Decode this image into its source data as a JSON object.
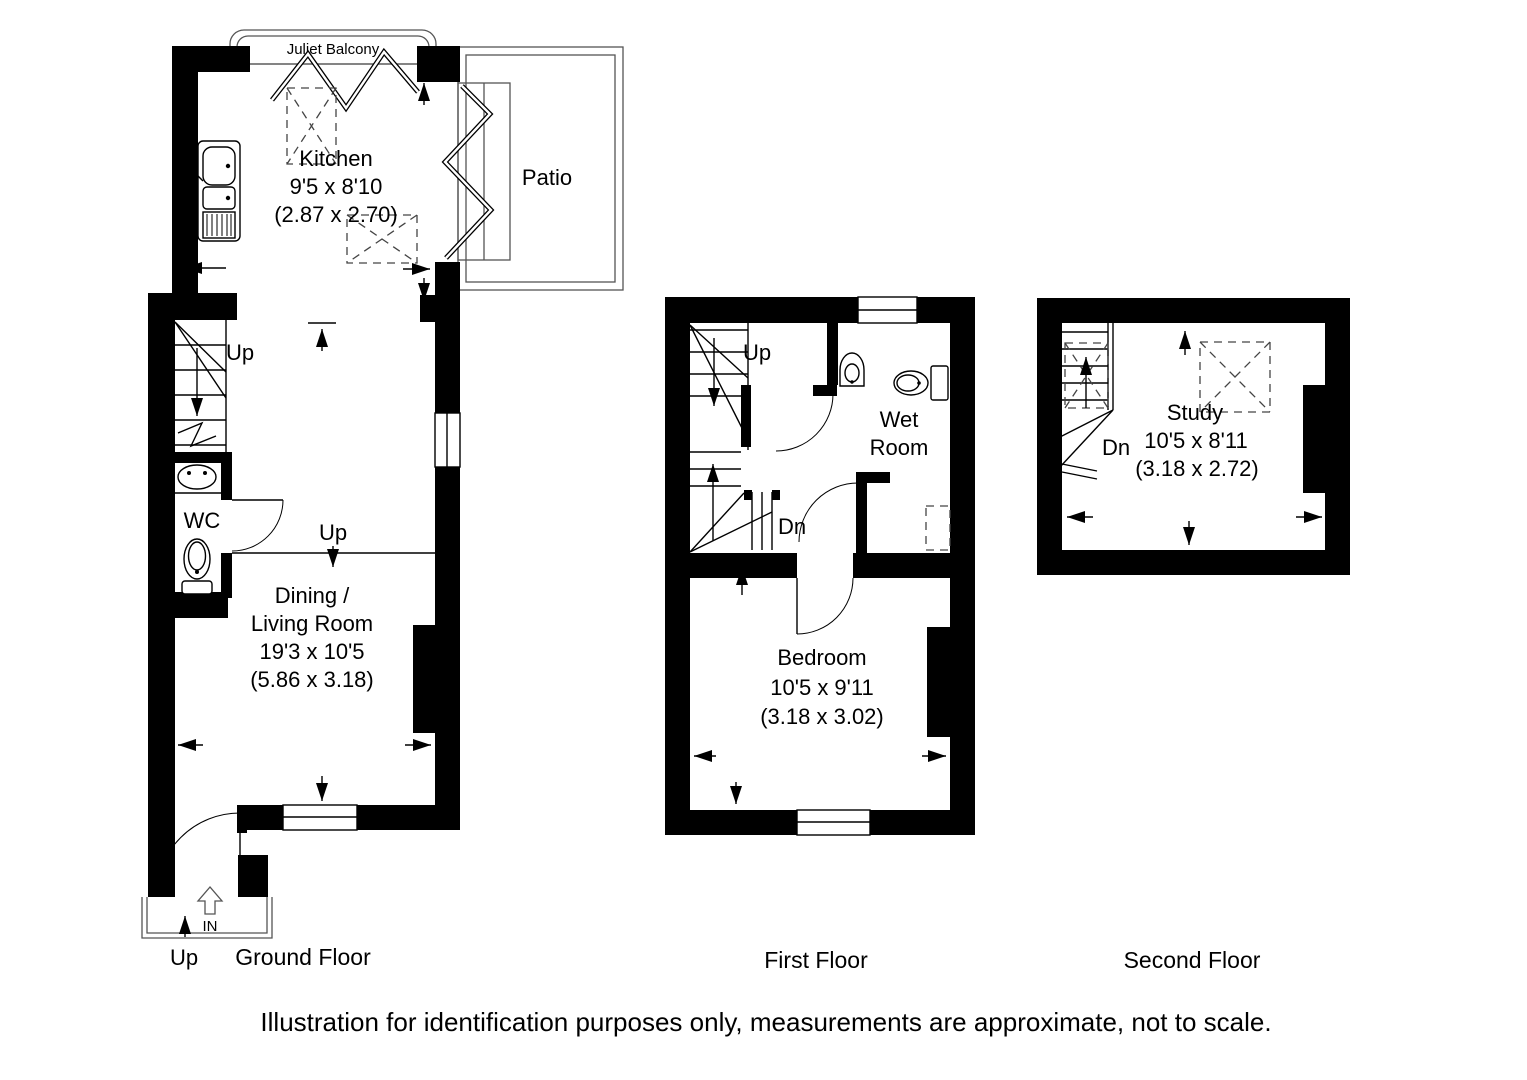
{
  "palette": {
    "wall": "#000000",
    "thin_line": "#555555",
    "background": "#ffffff"
  },
  "caption": "Illustration for identification purposes only, measurements are approximate, not to scale.",
  "floors": {
    "ground": {
      "label": "Ground Floor",
      "juliet_balcony": "Juliet Balcony",
      "patio": "Patio",
      "kitchen_name": "Kitchen",
      "kitchen_dims_imperial": "9'5 x 8'10",
      "kitchen_dims_metric": "(2.87 x 2.70)",
      "stairs_up": "Up",
      "wc": "WC",
      "room_up": "Up",
      "dining_name_1": "Dining /",
      "dining_name_2": "Living Room",
      "dining_dims_imperial": "19'3 x 10'5",
      "dining_dims_metric": "(5.86 x 3.18)",
      "entrance_in": "IN",
      "porch_up": "Up"
    },
    "first": {
      "label": "First Floor",
      "stairs_up": "Up",
      "stairs_dn": "Dn",
      "wet_room_1": "Wet",
      "wet_room_2": "Room",
      "bedroom_name": "Bedroom",
      "bedroom_dims_imperial": "10'5 x 9'11",
      "bedroom_dims_metric": "(3.18 x 3.02)"
    },
    "second": {
      "label": "Second Floor",
      "stairs_dn": "Dn",
      "study_name": "Study",
      "study_dims_imperial": "10'5 x 8'11",
      "study_dims_metric": "(3.18 x 2.72)"
    }
  }
}
